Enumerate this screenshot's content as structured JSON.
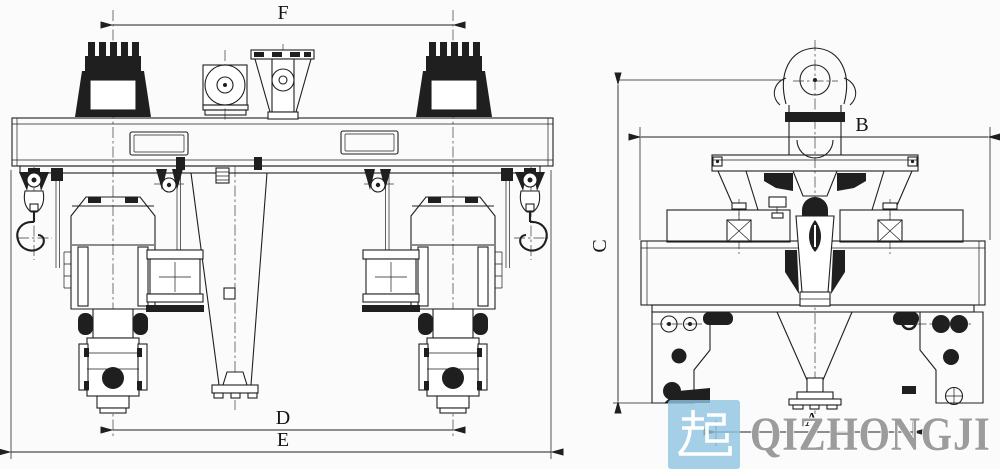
{
  "colors": {
    "line": "#1f1f1f",
    "background": "#fbfbfb",
    "watermark_box": "#8fc4e2",
    "watermark_glyph": "#ffffff",
    "watermark_text": "#9c9c9c"
  },
  "views": {
    "front": {
      "dim_top": "F",
      "dim_inner": "D",
      "dim_overall": "E"
    },
    "side": {
      "dim_width": "B",
      "dim_height": "C",
      "dim_gauge": "A"
    }
  },
  "watermark": {
    "logo_char": "起",
    "brand": "QIZHONGJI"
  }
}
